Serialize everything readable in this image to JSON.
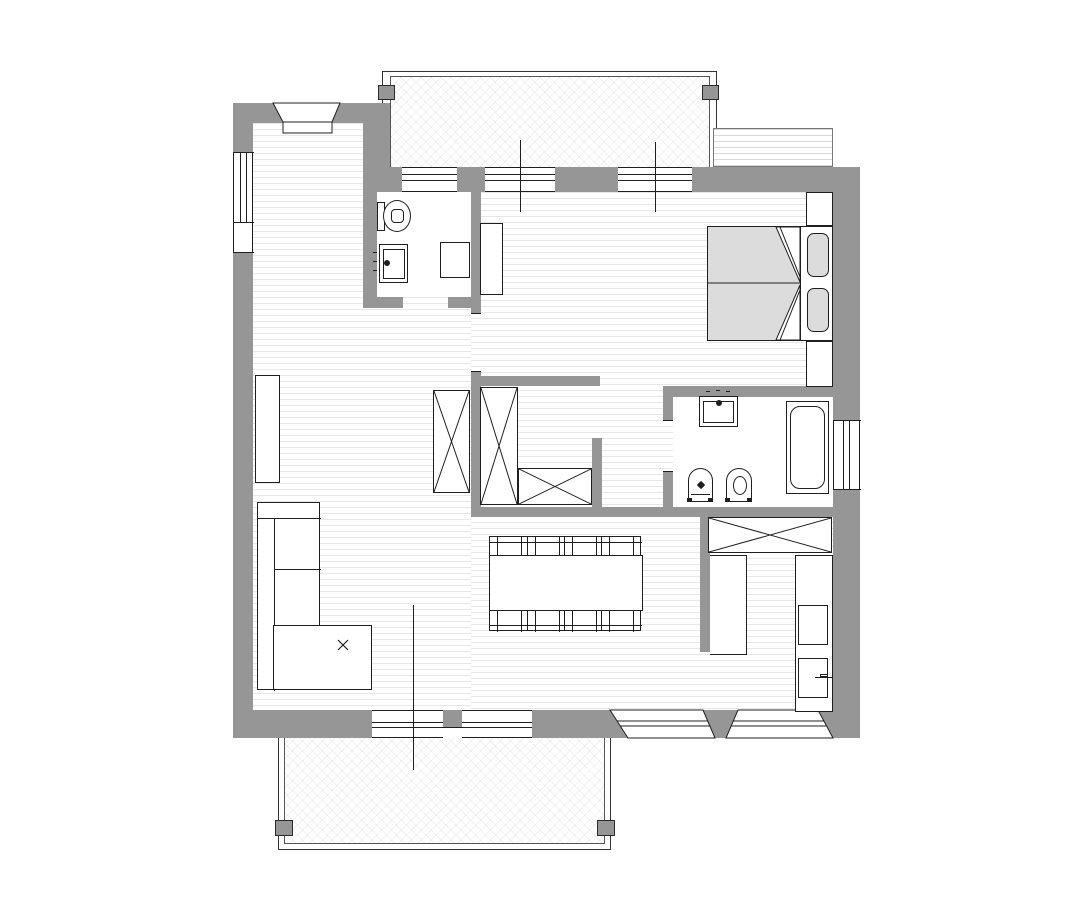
{
  "drawing": {
    "type": "apartment-floor-plan",
    "has_text_labels": false,
    "orientation": "top-down"
  },
  "colors": {
    "wall": "#969696",
    "line": "#1f1f1f",
    "floorline": "#e7e7e7",
    "furniture-fill": "#ffffff",
    "soft-fill": "#dcdcdc",
    "background": "#ffffff"
  },
  "rooms": [
    {
      "name": "living-dining-room",
      "floor": "hatched-lines",
      "furniture": [
        "corner-sofa",
        "ottoman-with-x-mark",
        "wall-console",
        "dining-table",
        "dining-chairs"
      ]
    },
    {
      "name": "bathroom-small",
      "floor": "plain",
      "fixtures": [
        "wall-hung-toilet",
        "washbasin",
        "shower-box"
      ]
    },
    {
      "name": "bedroom",
      "floor": "hatched-lines",
      "furniture": [
        "double-bed",
        "two-pillows",
        "two-nightstands",
        "dresser"
      ]
    },
    {
      "name": "walk-in-closet",
      "floor": "hatched-lines",
      "furniture": [
        "wardrobe-1",
        "wardrobe-2",
        "wardrobe-3"
      ]
    },
    {
      "name": "bathroom-main",
      "floor": "plain",
      "fixtures": [
        "washbasin",
        "bidet",
        "toilet",
        "bathtub"
      ]
    },
    {
      "name": "kitchen-corner",
      "floor": "hatched-lines",
      "furniture": [
        "wardrobe-kitchen",
        "tall-cabinet",
        "counter",
        "appliance-upper",
        "appliance-lower-with-handle"
      ]
    }
  ],
  "outdoor": [
    {
      "name": "balcony-top",
      "hatch": "diagonal-cross",
      "posts": 2
    },
    {
      "name": "balcony-bottom",
      "hatch": "diagonal-cross",
      "posts": 2
    },
    {
      "name": "awning-top-right",
      "hatch": "horizontal-lines"
    }
  ],
  "counts": {
    "dining_chairs": 8,
    "windows_top_wall": 3,
    "windows_bottom_wall": 4,
    "windows_left_wall": 1,
    "windows_right_wall": 1,
    "wardrobes_with_x": 4,
    "door_axis_lines": 3
  }
}
